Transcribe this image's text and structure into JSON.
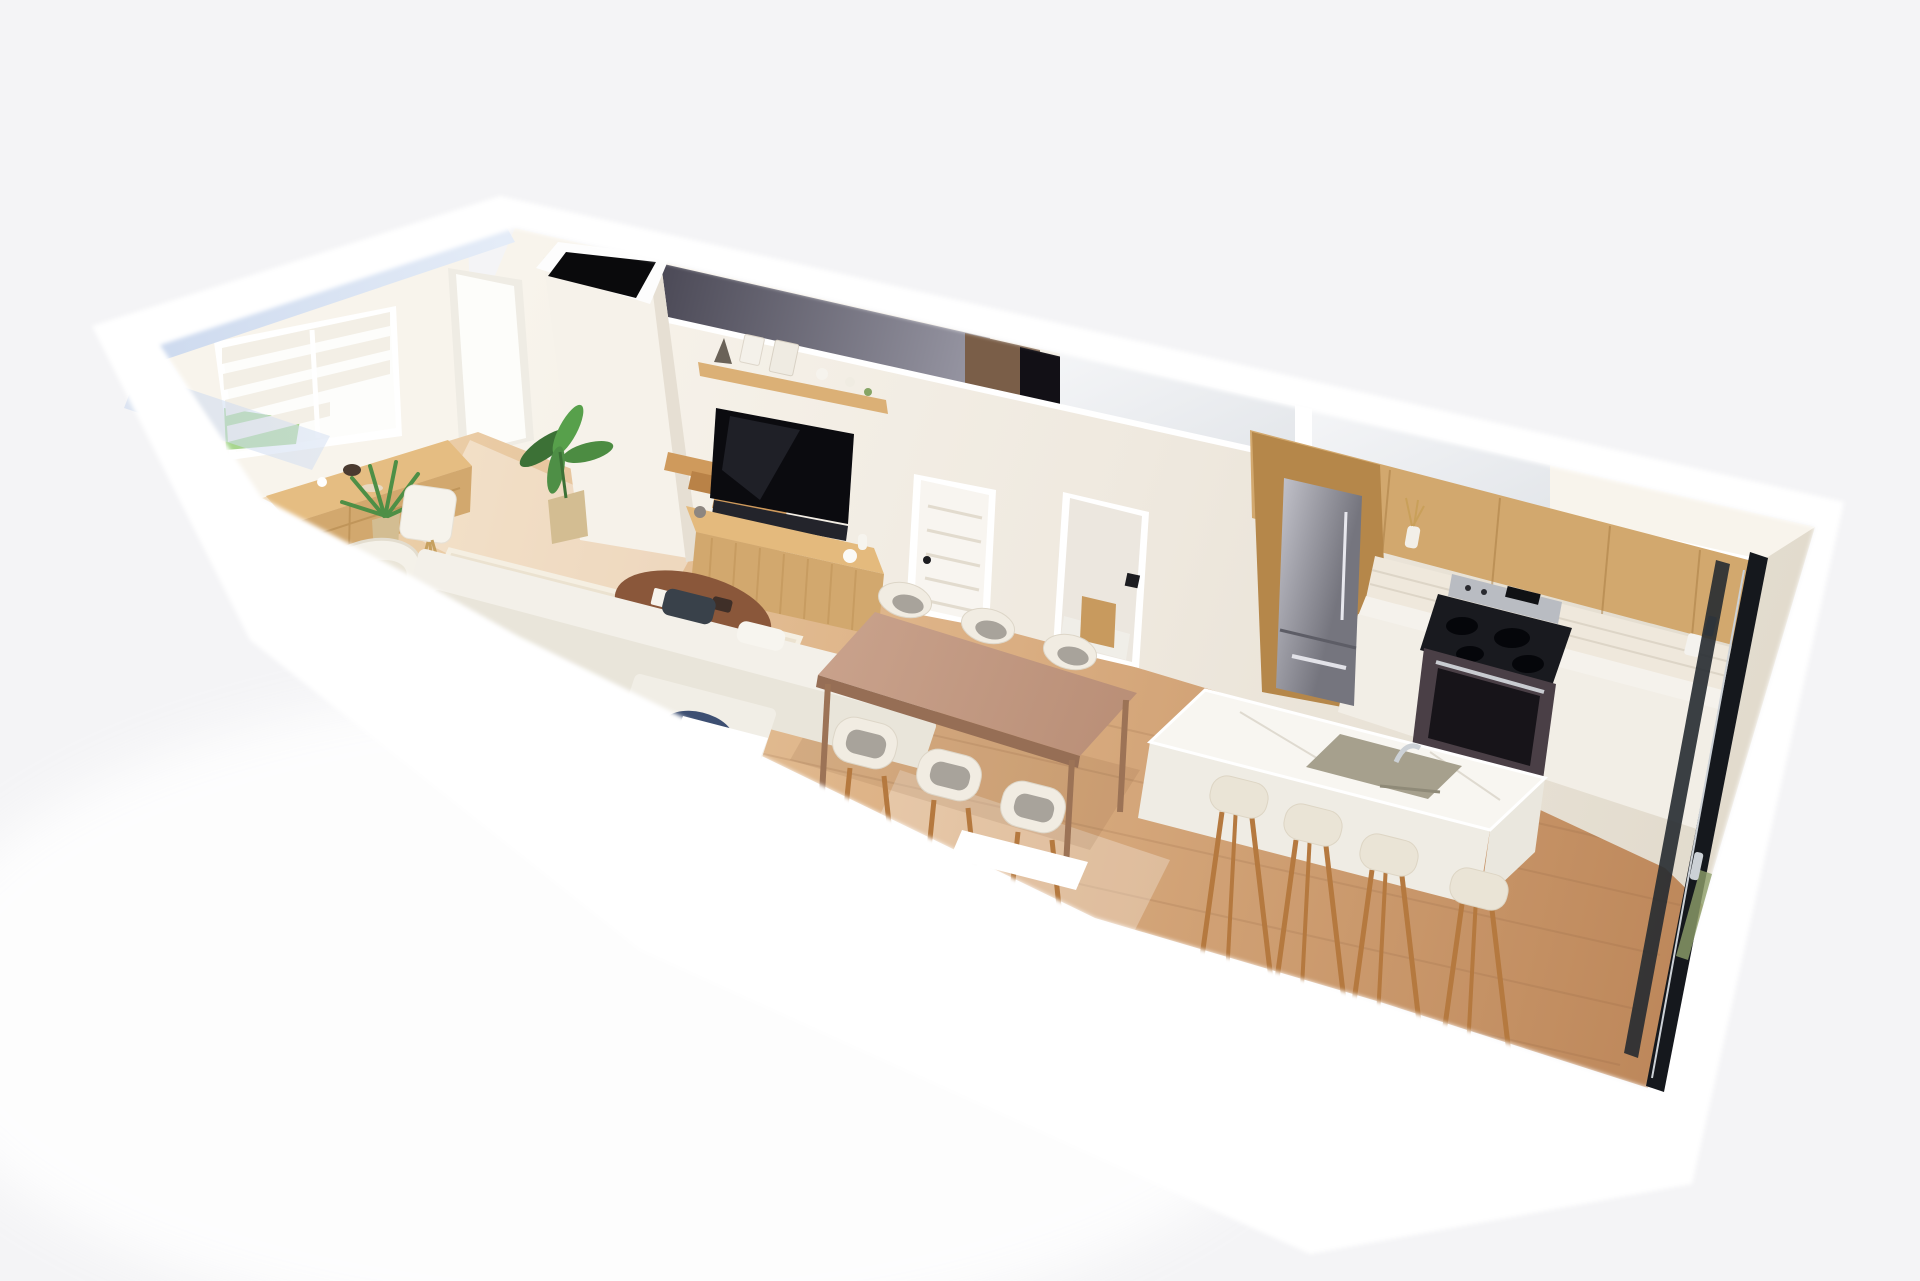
{
  "meta": {
    "title": "3D dollhouse cutaway rendering of a narrow one-level suite",
    "view": "isometric-top-down-floor-plan-render",
    "has_text": false
  },
  "palette": {
    "bg": "#f4f4f6",
    "band": "#ffffff",
    "wall": "#efe9df",
    "wallShade": "#e2dbcd",
    "wallLight": "#f8f4ec",
    "glassBlue": "#c9d7ee",
    "glassBlueLight": "#e4ecf8",
    "grayGlassDark": "#4b4956",
    "grayGlassLight": "#9a99a6",
    "upperWoodFloor": "#7a5e48",
    "holeBlack": "#0a0a0c",
    "floorLight": "#eed4af",
    "floorWarm": "#bd875a",
    "rug": "#ebe2d0",
    "oak": "#d2a86e",
    "oakDark": "#b5874a",
    "shelfWood": "#dbb076",
    "tv": "#0b0b0f",
    "soundbar": "#23242b",
    "door": "#f8f5f0",
    "doorLine": "#e2dbce",
    "tile": "#efe8dc",
    "counter": "#f5f2ec",
    "cabinet": "#f2eee6",
    "fridgeLight": "#c3c3cb",
    "fridgeDark": "#75757e",
    "stoveSteel": "#b9bcc2",
    "cooktop": "#191a1f",
    "oven": "#4a3f46",
    "island": "#f8f6f1",
    "islandSide": "#efece4",
    "sink": "#a6a08d",
    "chrome": "#ccd1d6",
    "stool": "#eae4d6",
    "legWood": "#b5793f",
    "tableWood": "#b98e76",
    "tableWoodDark": "#966e55",
    "chairShell": "#f1ece2",
    "chairCushion": "#a8a39b",
    "sofa": "#f3f0e9",
    "sofaSeat": "#e9e5da",
    "pillow": "#39414a",
    "walnut": "#8a573a",
    "navy": "#3d4f72",
    "plant": "#4e8f46",
    "plantDark": "#3c7136",
    "pot": "#d3bd92",
    "lamp": "#f6f3ec",
    "brass": "#c6a05f",
    "grass": "#a8d68e",
    "blind": "#f3efe6",
    "frameDark": "#15181d"
  },
  "scene": {
    "rooms": [
      {
        "name": "living-room",
        "items": [
          "window-with-zebra-blinds",
          "wood-sideboard",
          "potted-palm",
          "bird-of-paradise-plant",
          "floor-lamp",
          "white-armchair",
          "white-sofa-with-dark-pillows",
          "oval-walnut-coffee-table",
          "cream-area-rug",
          "navy-side-table",
          "wall-mounted-tv",
          "wood-display-shelf",
          "rattan-tv-console"
        ]
      },
      {
        "name": "entry",
        "items": [
          "entry-door",
          "stair-volume",
          "black-stairwell-opening",
          "wood-stair-treads"
        ]
      },
      {
        "name": "dining-area",
        "items": [
          "wood-dining-table",
          "dining-chairs",
          "white-five-panel-door",
          "hallway-opening-to-bathroom",
          "thermostat"
        ]
      },
      {
        "name": "kitchen",
        "items": [
          "oak-upper-cabinets",
          "subway-tile-backsplash",
          "marble-countertop",
          "white-base-cabinets",
          "stainless-bottom-freezer-fridge",
          "stainless-range-with-black-cooktop",
          "white-marble-waterfall-island",
          "undermount-sink-with-chrome-faucet",
          "bar-stools",
          "sliding-glass-door",
          "counter-jars"
        ]
      }
    ],
    "counts": {
      "dining_chairs": 6,
      "bar_stools": 4,
      "stair_treads": 5,
      "door_panels": 5
    },
    "second_floor_cut": [
      "smoked-glass-strip",
      "upper-wood-floor-sliver",
      "white-glass-floor-panels"
    ]
  }
}
